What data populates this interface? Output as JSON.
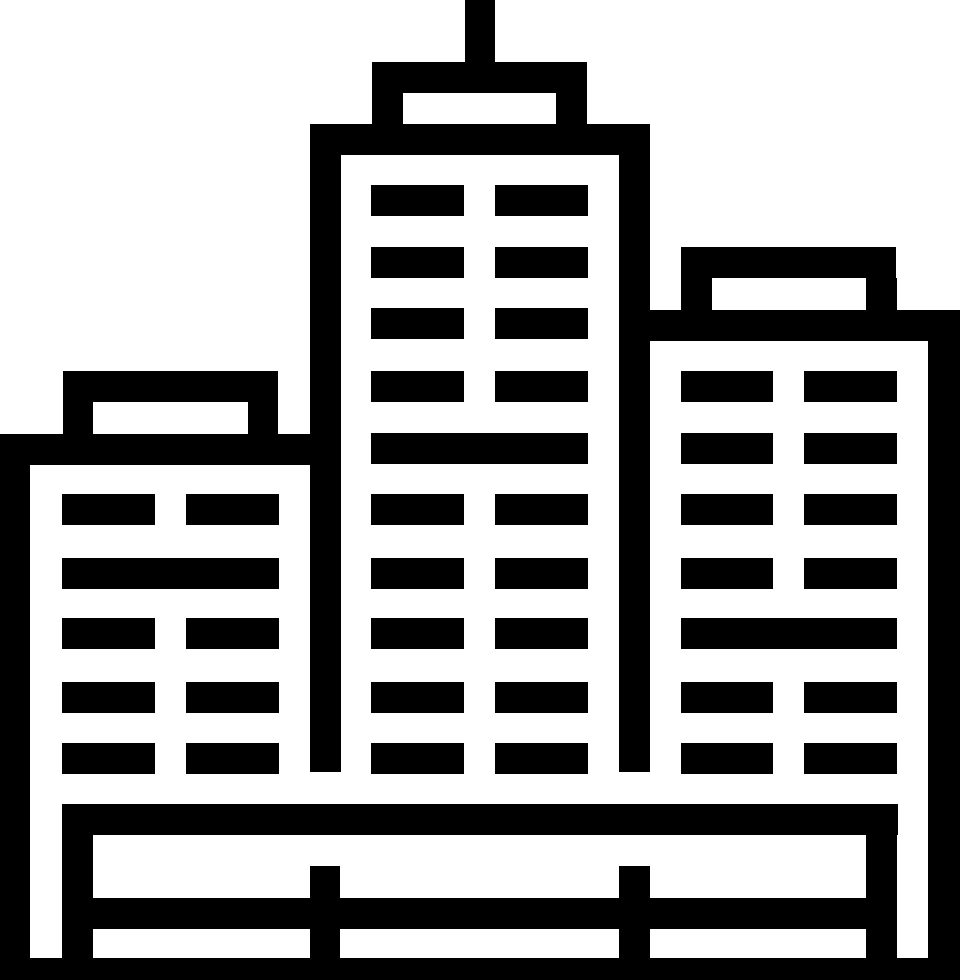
{
  "icon": {
    "name": "city-buildings-icon",
    "description": "Black pictogram of three skyscrapers with slatted windows, an antenna on the center tower, and a fenced base platform",
    "background_color": "#ffffff",
    "foreground_color": "#000000",
    "canvas": {
      "width": 960,
      "height": 980
    },
    "groups": [
      {
        "name": "antenna",
        "rects": [
          [
            465,
            0,
            30,
            62
          ]
        ]
      },
      {
        "name": "center-building-structure",
        "rects": [
          [
            372,
            62,
            215,
            31
          ],
          [
            372,
            93,
            31,
            31
          ],
          [
            556,
            93,
            31,
            31
          ],
          [
            310,
            124,
            340,
            31
          ],
          [
            310,
            155,
            31,
            617
          ],
          [
            619,
            155,
            31,
            617
          ]
        ]
      },
      {
        "name": "center-building-windows",
        "rects": [
          [
            371,
            185,
            93,
            31
          ],
          [
            495,
            185,
            93,
            31
          ],
          [
            371,
            247,
            93,
            31
          ],
          [
            495,
            247,
            93,
            31
          ],
          [
            371,
            308,
            93,
            31
          ],
          [
            495,
            308,
            93,
            31
          ],
          [
            371,
            371,
            93,
            31
          ],
          [
            495,
            371,
            93,
            31
          ],
          [
            371,
            433,
            217,
            31
          ],
          [
            371,
            494,
            93,
            31
          ],
          [
            495,
            494,
            93,
            31
          ],
          [
            371,
            558,
            93,
            31
          ],
          [
            495,
            558,
            93,
            31
          ],
          [
            371,
            618,
            93,
            31
          ],
          [
            495,
            618,
            93,
            31
          ],
          [
            371,
            682,
            93,
            31
          ],
          [
            495,
            682,
            93,
            31
          ],
          [
            371,
            743,
            93,
            31
          ],
          [
            495,
            743,
            93,
            31
          ]
        ]
      },
      {
        "name": "left-building-structure",
        "rects": [
          [
            63,
            371,
            215,
            31
          ],
          [
            63,
            402,
            30,
            32
          ],
          [
            248,
            402,
            30,
            32
          ],
          [
            0,
            434,
            341,
            31
          ],
          [
            0,
            465,
            30,
            515
          ]
        ]
      },
      {
        "name": "left-building-windows",
        "rects": [
          [
            62,
            494,
            93,
            31
          ],
          [
            186,
            494,
            93,
            31
          ],
          [
            62,
            558,
            217,
            31
          ],
          [
            62,
            618,
            93,
            31
          ],
          [
            186,
            618,
            93,
            31
          ],
          [
            62,
            682,
            93,
            31
          ],
          [
            186,
            682,
            93,
            31
          ],
          [
            62,
            743,
            93,
            31
          ],
          [
            186,
            743,
            93,
            31
          ]
        ]
      },
      {
        "name": "right-building-structure",
        "rects": [
          [
            681,
            247,
            215,
            31
          ],
          [
            681,
            278,
            31,
            32
          ],
          [
            866,
            278,
            31,
            32
          ],
          [
            650,
            310,
            310,
            31
          ],
          [
            928,
            341,
            32,
            639
          ]
        ]
      },
      {
        "name": "right-building-windows",
        "rects": [
          [
            681,
            371,
            92,
            31
          ],
          [
            804,
            371,
            93,
            31
          ],
          [
            681,
            433,
            92,
            31
          ],
          [
            804,
            433,
            93,
            31
          ],
          [
            681,
            494,
            92,
            31
          ],
          [
            804,
            494,
            93,
            31
          ],
          [
            681,
            558,
            92,
            31
          ],
          [
            804,
            558,
            93,
            31
          ],
          [
            681,
            618,
            216,
            31
          ],
          [
            681,
            682,
            92,
            31
          ],
          [
            804,
            682,
            93,
            31
          ],
          [
            681,
            743,
            92,
            31
          ],
          [
            804,
            743,
            93,
            31
          ]
        ]
      },
      {
        "name": "base-fence",
        "rects": [
          [
            62,
            804,
            836,
            31
          ],
          [
            62,
            835,
            31,
            123
          ],
          [
            866,
            835,
            31,
            123
          ],
          [
            310,
            866,
            30,
            92
          ],
          [
            619,
            866,
            31,
            92
          ],
          [
            93,
            898,
            774,
            31
          ],
          [
            0,
            958,
            960,
            22
          ]
        ]
      }
    ]
  }
}
